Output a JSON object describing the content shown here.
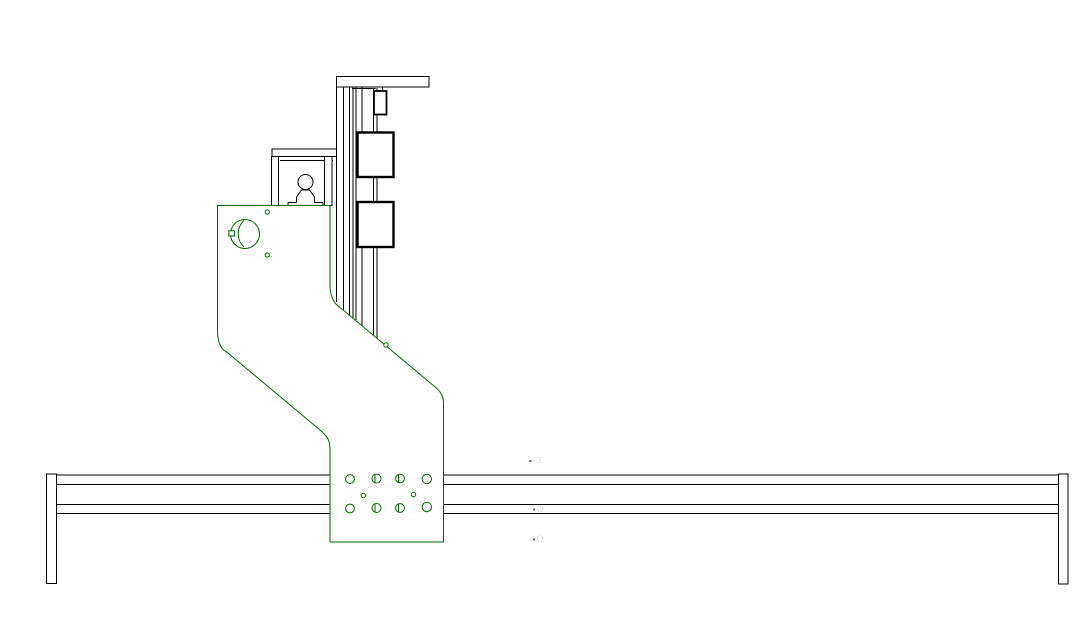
{
  "canvas": {
    "width": 1087,
    "height": 641,
    "background": "#ffffff"
  },
  "colors": {
    "line": "#000000",
    "plate": "#006400",
    "plate-accent": "#004000",
    "faint-mark": "#c4c4c4",
    "faint-dot": "#606060",
    "bg": "#ffffff"
  },
  "drawing": {
    "type": "cad-line-drawing",
    "visible_text": "",
    "parts": {
      "rail": {
        "label": "X-axis rail extrusion"
      },
      "left_leg": {
        "label": "Left rail end plate"
      },
      "right_leg": {
        "label": "Right rail end plate"
      },
      "top_plate": {
        "label": "Column top plate"
      },
      "column": {
        "label": "Z-axis column"
      },
      "small_block": {
        "label": "Shaft coupler block"
      },
      "upper_block": {
        "label": "Upper carriage block"
      },
      "lower_block": {
        "label": "Lower carriage block"
      },
      "bracket": {
        "label": "Motor mount bracket"
      },
      "gantry_plate": {
        "label": "Gantry side plate"
      },
      "bolt_holes": {
        "label": "Mounting bolt holes"
      },
      "center_marks": {
        "label": "Faint center marks"
      }
    }
  }
}
